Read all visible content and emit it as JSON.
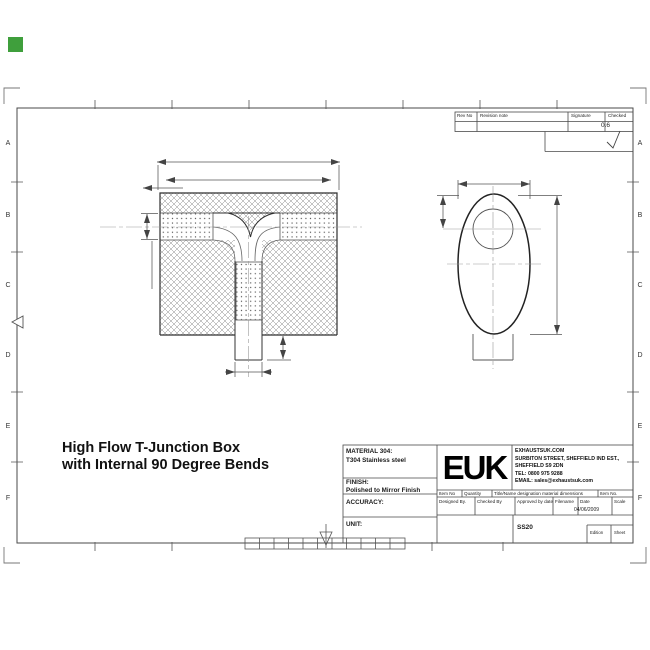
{
  "marker_color": "#3f9f3c",
  "drawing_title": {
    "line1": "High Flow T-Junction Box",
    "line2": "with Internal 90 Degree Bends"
  },
  "grid": {
    "rows": [
      "A",
      "B",
      "C",
      "D",
      "E",
      "F"
    ]
  },
  "revision_table": {
    "rev_no": "Rev No",
    "revision_note": "Revision note",
    "signature": "Signature",
    "checked": "Checked",
    "surface_finish": "0.6"
  },
  "title_block": {
    "material_label": "MATERIAL 304:",
    "material_value": "T304 Stainless steel",
    "finish_label": "FINISH:",
    "finish_value": "Polished to Mirror Finish",
    "accuracy_label": "ACCURACY:",
    "unit_label": "UNIT:",
    "logo": "EUK",
    "company": {
      "line1": "EXHAUSTSUK.COM",
      "line2": "SURBITON STREET, SHEFFIELD IND EST.,",
      "line3": "SHEFFIELD S9 2DN",
      "line4": "TEL: 0800 975 9288",
      "line5": "EMAIL: sales@exhaustsuk.com"
    },
    "row1": {
      "item_no": "Item No",
      "quantity": "Quantity",
      "designation": "Title/Name designation material dimensions",
      "item_no2": "Item No."
    },
    "row2": {
      "designed_by": "Designed By.",
      "checked_by": "Checked By",
      "approved": "Approved by date",
      "filename": "Filename",
      "date_label": "Date",
      "date_value": "04/06/2009",
      "scale_label": "Scale"
    },
    "row3": {
      "drawing_no": "SS20",
      "edition": "Edition",
      "sheet": "Sheet"
    }
  }
}
